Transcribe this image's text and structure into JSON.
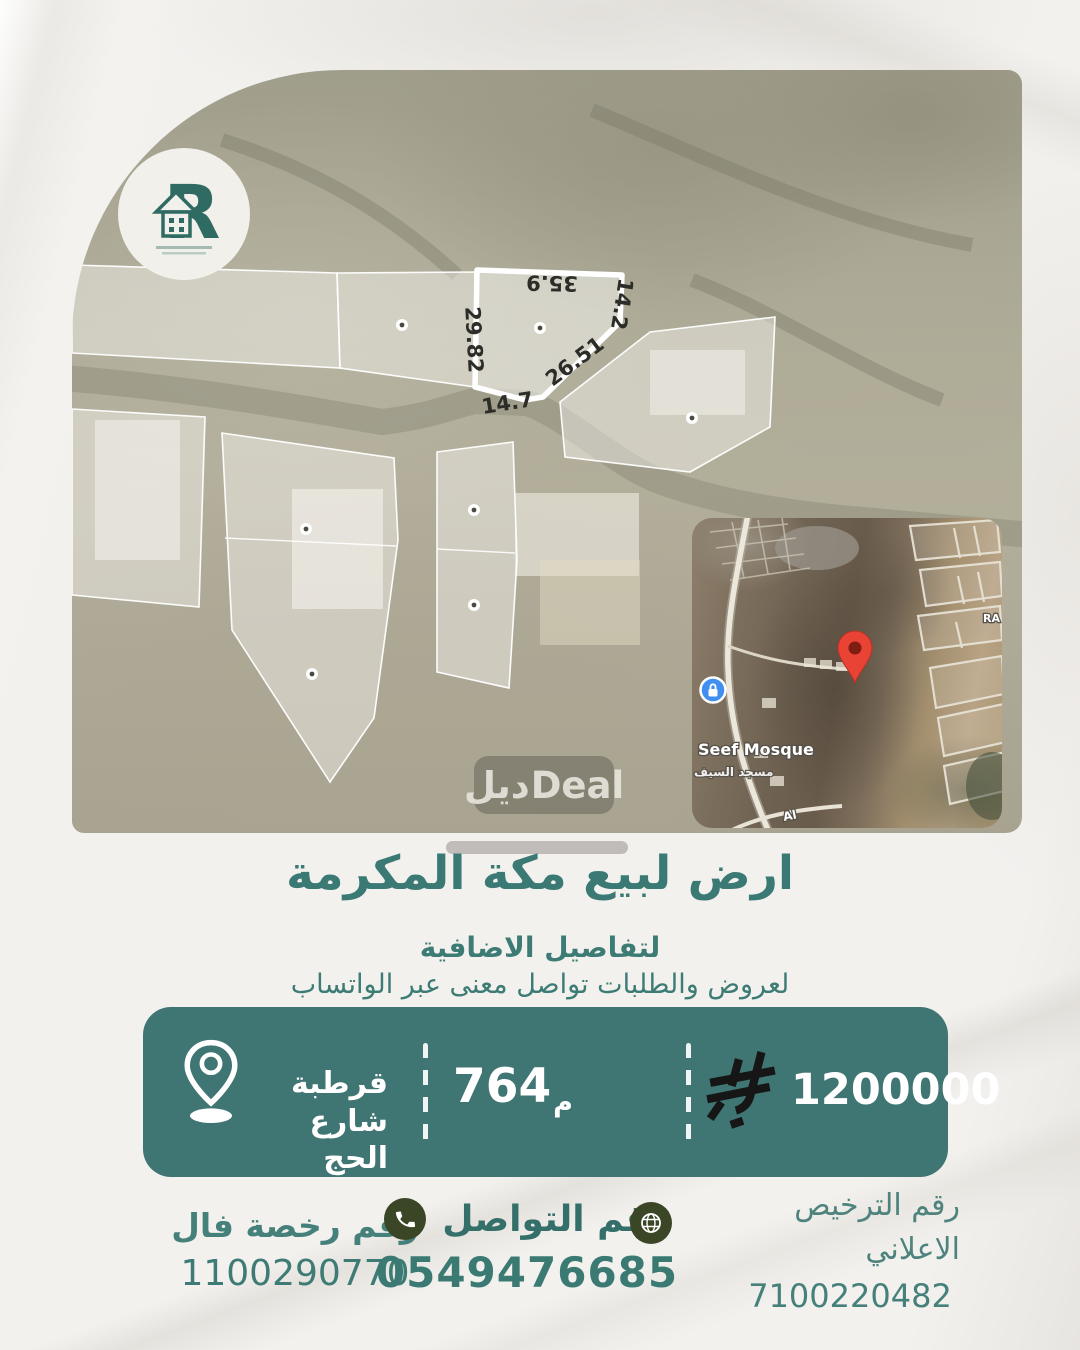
{
  "brand": {
    "logo_letter": "R",
    "watermark_ar": "ديل",
    "watermark_en": "Deal"
  },
  "map": {
    "labels": {
      "top": "35.9",
      "right": "14.2",
      "left": "29.82",
      "diagonal": "26.51",
      "bottom": "14.7"
    }
  },
  "inset": {
    "poi_en": "Seef Mosque",
    "poi_ar": "مسجد السيف",
    "road_label": "Al",
    "side_label": "RA"
  },
  "listing": {
    "title": "ارض لبيع مكة المكرمة",
    "subtitle1": "لتفاصيل الاضافية",
    "subtitle2": "لعروض والطلبات تواصل معنى عبر الواتساب"
  },
  "banner": {
    "location_line1": "قرطبة شارع",
    "location_line2": "الحج",
    "area_value": "764",
    "area_unit": "م",
    "price": "1200000"
  },
  "footer": {
    "fal_label": "رقم رخصة فال",
    "fal_number": "1100290770",
    "contact_label": "رقم التواصل",
    "contact_number": "0549476685",
    "ad_label_line1": "رقم الترخيص",
    "ad_label_line2": "الاعلاني",
    "ad_number": "7100220482"
  },
  "colors": {
    "teal_text": "#3b7a74",
    "banner_teal": "#3f7572",
    "icon_olive": "#3a4625",
    "riyal_black": "#161616",
    "pin_red": "#e94335",
    "poi_blue": "#3f8ef0",
    "paper": "#f3f1ee"
  }
}
